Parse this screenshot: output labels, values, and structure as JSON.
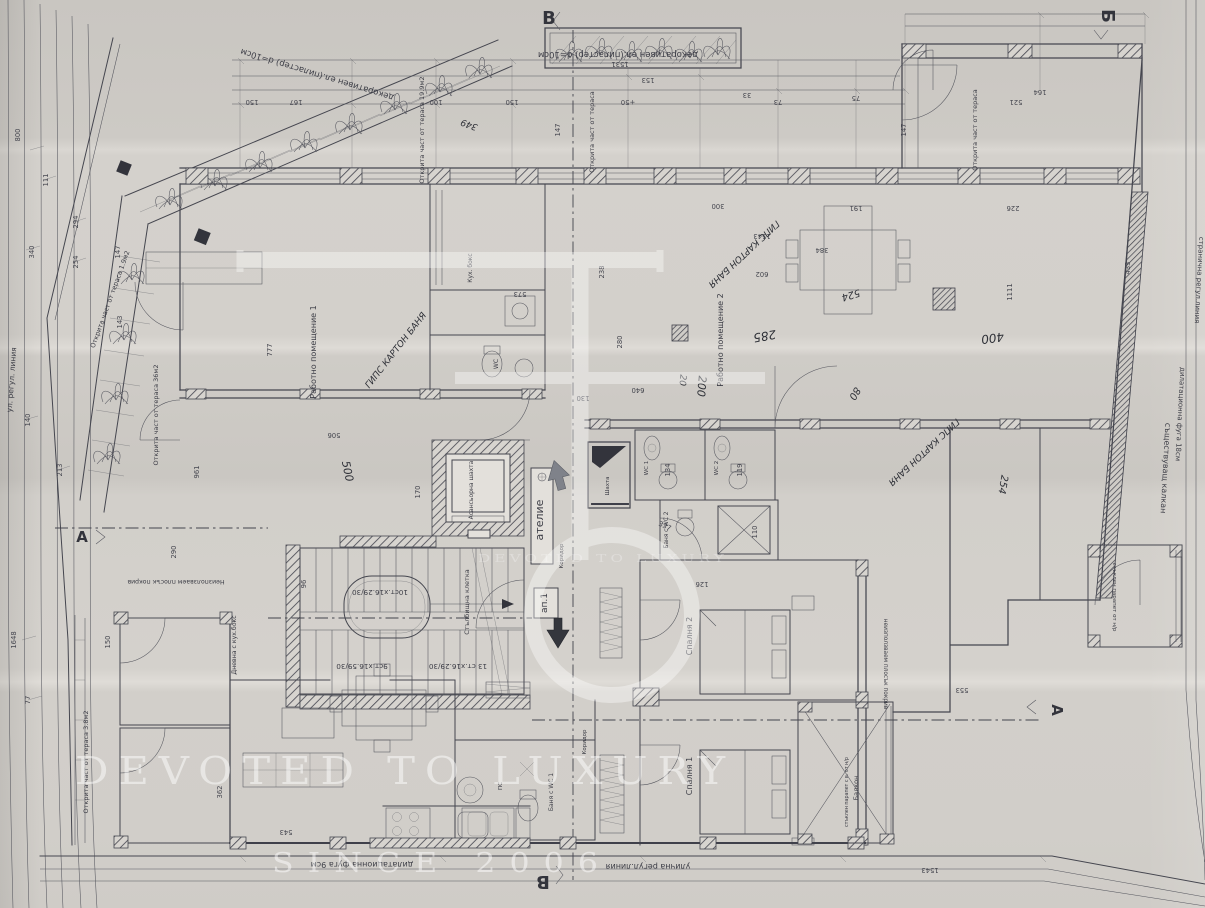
{
  "document": {
    "type": "scanned architectural floor plan photo",
    "language": "Bulgarian"
  },
  "palette": {
    "paper": "#d2cfca",
    "paper_dark": "#c9c6c1",
    "paper_light": "#dedbd6",
    "ink": "#45464f",
    "ink_dark": "#33343c",
    "arrow_gray": "#7f828a",
    "watermark_white": "#ffffff"
  },
  "watermark": {
    "monogram": "E",
    "line1": "DEVOTED TO LUXURY",
    "line2": "SINCE 2006",
    "echo": "DEVOTED TO LUXURY"
  },
  "plan": {
    "section_markers": [
      {
        "t": "В",
        "x": 549,
        "y": 24,
        "r": 0,
        "s": 18,
        "n": "section-marker-v-top"
      },
      {
        "t": "Б",
        "x": 1102,
        "y": 16,
        "r": 90,
        "s": 18,
        "n": "section-marker-b-topright"
      },
      {
        "t": "В",
        "x": 543,
        "y": 876,
        "r": 180,
        "s": 18,
        "n": "section-marker-v-bottom"
      },
      {
        "t": "А",
        "x": 1052,
        "y": 710,
        "r": 90,
        "s": 15,
        "n": "section-marker-a-right"
      },
      {
        "t": "А",
        "x": 82,
        "y": 542,
        "r": 0,
        "s": 15,
        "n": "section-marker-a-left"
      }
    ],
    "labels": [
      {
        "t": "декоративен ел.(пиластер) d=10см",
        "x": 618,
        "y": 52,
        "r": 180,
        "s": 8.5
      },
      {
        "t": "декоративен ел.(пиластер) d=10см",
        "x": 318,
        "y": 72,
        "r": 197,
        "s": 8.5
      },
      {
        "t": "Открита част от тераса 19.9м2",
        "x": 424,
        "y": 130,
        "r": -90,
        "s": 6.5
      },
      {
        "t": "Открита част от тераса",
        "x": 594,
        "y": 132,
        "r": -90,
        "s": 6.5
      },
      {
        "t": "Открита част от тераса",
        "x": 977,
        "y": 130,
        "r": -90,
        "s": 6.5
      },
      {
        "t": "Открита част от тераса 1.9м2",
        "x": 112,
        "y": 300,
        "r": -70,
        "s": 6.5
      },
      {
        "t": "Открита част от тераса 36м2",
        "x": 158,
        "y": 415,
        "r": -90,
        "s": 6.5
      },
      {
        "t": "Открита част от тераса 3.8м2",
        "x": 88,
        "y": 762,
        "r": -90,
        "s": 6.5
      },
      {
        "t": "ул. регул. линия",
        "x": 14,
        "y": 380,
        "r": -86,
        "s": 7.5
      },
      {
        "t": "Работно помещение 1",
        "x": 316,
        "y": 352,
        "r": -90,
        "s": 8
      },
      {
        "t": "Работно помещение 2",
        "x": 723,
        "y": 340,
        "r": -90,
        "s": 8
      },
      {
        "t": "Асансьорна шахта",
        "x": 473,
        "y": 490,
        "r": -90,
        "s": 6
      },
      {
        "t": "Стълбищна клетка",
        "x": 469,
        "y": 602,
        "r": -90,
        "s": 6.5
      },
      {
        "t": "ателие",
        "x": 543,
        "y": 520,
        "r": -90,
        "s": 11
      },
      {
        "t": "ап.1",
        "x": 547,
        "y": 603,
        "r": -90,
        "s": 9
      },
      {
        "t": "Коридор",
        "x": 563,
        "y": 556,
        "r": -90,
        "s": 5.5
      },
      {
        "t": "Коридор",
        "x": 586,
        "y": 742,
        "r": -90,
        "s": 5.5
      },
      {
        "t": "Шахта",
        "x": 609,
        "y": 486,
        "r": -90,
        "s": 5.5
      },
      {
        "t": "Кух. бокс",
        "x": 472,
        "y": 268,
        "r": -90,
        "s": 6
      },
      {
        "t": "WC",
        "x": 498,
        "y": 364,
        "r": -90,
        "s": 6
      },
      {
        "t": "WC 1",
        "x": 648,
        "y": 468,
        "r": -90,
        "s": 5.5
      },
      {
        "t": "WC 2",
        "x": 718,
        "y": 468,
        "r": -90,
        "s": 5.5
      },
      {
        "t": "Баня с WC 2",
        "x": 668,
        "y": 530,
        "r": -90,
        "s": 5.8
      },
      {
        "t": "Баня с WC 1",
        "x": 553,
        "y": 792,
        "r": -90,
        "s": 6
      },
      {
        "t": "ПС",
        "x": 502,
        "y": 786,
        "r": -90,
        "s": 5.5
      },
      {
        "t": "Спалня 2",
        "x": 692,
        "y": 636,
        "r": -90,
        "s": 8
      },
      {
        "t": "Спалня 1",
        "x": 692,
        "y": 776,
        "r": -90,
        "s": 8
      },
      {
        "t": "Дневна с кух.бокс",
        "x": 236,
        "y": 645,
        "r": -90,
        "s": 6.2
      },
      {
        "t": "Балкон",
        "x": 858,
        "y": 788,
        "r": -90,
        "s": 6.5
      },
      {
        "t": "стъклен парапет с в. от н/р",
        "x": 848,
        "y": 792,
        "r": -90,
        "s": 4.8
      },
      {
        "t": "стъклен парапет от н/р",
        "x": 1113,
        "y": 597,
        "r": 90,
        "s": 5.5
      },
      {
        "t": "Неизползваем плосък покрив",
        "x": 176,
        "y": 580,
        "r": 180,
        "s": 6.2
      },
      {
        "t": "неизползваем плосък покрив",
        "x": 884,
        "y": 664,
        "r": 90,
        "s": 5.8
      },
      {
        "t": "съществуващ калкан",
        "x": 1163,
        "y": 468,
        "r": 93,
        "s": 8
      },
      {
        "t": "дилатационна фуга 18см",
        "x": 1178,
        "y": 414,
        "r": 93,
        "s": 7
      },
      {
        "t": "странична регул.линия",
        "x": 1197,
        "y": 280,
        "r": 93,
        "s": 7
      },
      {
        "t": "дилатационна фуга 9см",
        "x": 362,
        "y": 862,
        "r": 180,
        "s": 8
      },
      {
        "t": "улична регул.линия",
        "x": 648,
        "y": 864,
        "r": 180,
        "s": 8
      },
      {
        "t": "10ст.х16.29/30",
        "x": 380,
        "y": 590,
        "r": 180,
        "s": 7.2
      },
      {
        "t": "9ст.х16.59/30",
        "x": 362,
        "y": 664,
        "r": 180,
        "s": 7.2
      },
      {
        "t": "13 ст.х16.29/30",
        "x": 458,
        "y": 664,
        "r": 180,
        "s": 7.2
      }
    ],
    "hand_notes": [
      {
        "t": "ГИПС КАРТОН БАНЯ",
        "x": 398,
        "y": 352,
        "r": -52,
        "s": 9
      },
      {
        "t": "ГИПС КАРТОН БАНЯ",
        "x": 742,
        "y": 252,
        "r": 137,
        "s": 9
      },
      {
        "t": "ГИПС КАРТОН БАНЯ",
        "x": 922,
        "y": 450,
        "r": 137,
        "s": 9
      },
      {
        "t": "285",
        "x": 764,
        "y": 332,
        "r": 170,
        "s": 12
      },
      {
        "t": "200",
        "x": 698,
        "y": 386,
        "r": 95,
        "s": 11
      },
      {
        "t": "20",
        "x": 680,
        "y": 380,
        "r": 95,
        "s": 9
      },
      {
        "t": "400",
        "x": 992,
        "y": 334,
        "r": 172,
        "s": 12
      },
      {
        "t": "500",
        "x": 344,
        "y": 472,
        "r": 78,
        "s": 11
      },
      {
        "t": "80",
        "x": 852,
        "y": 392,
        "r": 120,
        "s": 10
      },
      {
        "t": "524",
        "x": 850,
        "y": 292,
        "r": 163,
        "s": 10
      },
      {
        "t": "254",
        "x": 1000,
        "y": 484,
        "r": 100,
        "s": 10
      },
      {
        "t": "349",
        "x": 470,
        "y": 122,
        "r": 200,
        "s": 9
      }
    ],
    "dims": [
      {
        "t": "167",
        "x": 296,
        "y": 100,
        "r": 180
      },
      {
        "t": "150",
        "x": 252,
        "y": 100,
        "r": 180
      },
      {
        "t": "100",
        "x": 436,
        "y": 100,
        "r": 180
      },
      {
        "t": "150",
        "x": 512,
        "y": 100,
        "r": 180
      },
      {
        "t": "+50",
        "x": 628,
        "y": 100,
        "r": 180
      },
      {
        "t": "73",
        "x": 778,
        "y": 100,
        "r": 180
      },
      {
        "t": "75",
        "x": 856,
        "y": 96,
        "r": 180
      },
      {
        "t": "164",
        "x": 1040,
        "y": 90,
        "r": 180
      },
      {
        "t": "153",
        "x": 648,
        "y": 78,
        "r": 180
      },
      {
        "t": "1531",
        "x": 620,
        "y": 62,
        "r": 180
      },
      {
        "t": "33",
        "x": 747,
        "y": 93,
        "r": 180
      },
      {
        "t": "521",
        "x": 1016,
        "y": 100,
        "r": 180
      },
      {
        "t": "226",
        "x": 1013,
        "y": 206,
        "r": 180
      },
      {
        "t": "191",
        "x": 856,
        "y": 206,
        "r": 180
      },
      {
        "t": "573",
        "x": 520,
        "y": 292,
        "r": 180
      },
      {
        "t": "238",
        "x": 604,
        "y": 272,
        "r": -90
      },
      {
        "t": "280",
        "x": 622,
        "y": 342,
        "r": -90
      },
      {
        "t": "130",
        "x": 583,
        "y": 396,
        "r": 180
      },
      {
        "t": "640",
        "x": 638,
        "y": 388,
        "r": 180
      },
      {
        "t": "300",
        "x": 718,
        "y": 204,
        "r": 180
      },
      {
        "t": "1543",
        "x": 762,
        "y": 234,
        "r": 180
      },
      {
        "t": "384",
        "x": 822,
        "y": 248,
        "r": 180
      },
      {
        "t": "602",
        "x": 762,
        "y": 272,
        "r": 180
      },
      {
        "t": "1111",
        "x": 1012,
        "y": 292,
        "r": -90
      },
      {
        "t": "433",
        "x": 1130,
        "y": 268,
        "r": -90
      },
      {
        "t": "961",
        "x": 199,
        "y": 472,
        "r": -90
      },
      {
        "t": "506",
        "x": 334,
        "y": 433,
        "r": 180
      },
      {
        "t": "290",
        "x": 176,
        "y": 552,
        "r": -90
      },
      {
        "t": "96",
        "x": 306,
        "y": 584,
        "r": -90
      },
      {
        "t": "170",
        "x": 420,
        "y": 492,
        "r": -90
      },
      {
        "t": "134",
        "x": 670,
        "y": 470,
        "r": -90
      },
      {
        "t": "119",
        "x": 742,
        "y": 470,
        "r": -90
      },
      {
        "t": "110",
        "x": 757,
        "y": 532,
        "r": -90
      },
      {
        "t": "126",
        "x": 702,
        "y": 582,
        "r": 180
      },
      {
        "t": "337",
        "x": 664,
        "y": 528,
        "r": 25
      },
      {
        "t": "362",
        "x": 222,
        "y": 792,
        "r": -90
      },
      {
        "t": "543",
        "x": 286,
        "y": 830,
        "r": 180
      },
      {
        "t": "553",
        "x": 962,
        "y": 688,
        "r": 180
      },
      {
        "t": "800",
        "x": 20,
        "y": 135,
        "r": -90
      },
      {
        "t": "340",
        "x": 34,
        "y": 252,
        "r": -90
      },
      {
        "t": "140",
        "x": 30,
        "y": 420,
        "r": -90
      },
      {
        "t": "1648",
        "x": 16,
        "y": 640,
        "r": -90
      },
      {
        "t": "77",
        "x": 30,
        "y": 700,
        "r": -90
      },
      {
        "t": "111",
        "x": 48,
        "y": 180,
        "r": -90
      },
      {
        "t": "294",
        "x": 78,
        "y": 222,
        "r": -90
      },
      {
        "t": "254",
        "x": 78,
        "y": 262,
        "r": -90
      },
      {
        "t": "213",
        "x": 62,
        "y": 470,
        "r": -90
      },
      {
        "t": "150",
        "x": 110,
        "y": 642,
        "r": -90
      },
      {
        "t": "143",
        "x": 122,
        "y": 322,
        "r": -90
      },
      {
        "t": "147",
        "x": 120,
        "y": 252,
        "r": -90
      },
      {
        "t": "777",
        "x": 272,
        "y": 350,
        "r": -90
      },
      {
        "t": "147",
        "x": 560,
        "y": 130,
        "r": -90
      },
      {
        "t": "147",
        "x": 906,
        "y": 130,
        "r": -90
      },
      {
        "t": "1543",
        "x": 930,
        "y": 868,
        "r": 180
      }
    ],
    "stair_specs": [
      "10ст.х16.29/30",
      "9ст.х16.59/30",
      "13 ст.х16.29/30"
    ]
  }
}
